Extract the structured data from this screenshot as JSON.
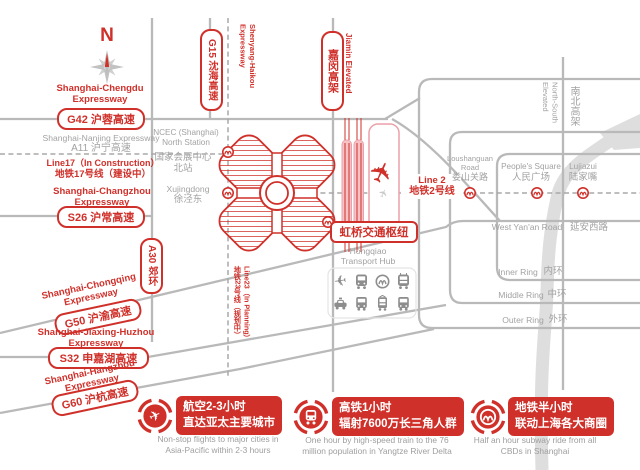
{
  "map": {
    "compass": {
      "n": "N"
    },
    "expressways": {
      "chengdu": {
        "l1": "Shanghai-Chengdu",
        "l2": "Expressway",
        "badge": "G42 沪蓉高速"
      },
      "nanjing": {
        "l1": "Shanghai-Nanjing Expressway",
        "l2": "A11 沪宁高速"
      },
      "line17": {
        "l1": "Line17（In Construction）",
        "l2": "地铁17号线（建设中）"
      },
      "changzhou": {
        "l1": "Shanghai-Changzhou",
        "l2": "Expressway",
        "badge": "S26 沪常高速"
      },
      "chongqing": {
        "l1": "Shanghai-Chongqing",
        "l2": "Expressway",
        "badge": "G50 沪渝高速"
      },
      "jiaxing": {
        "l1": "Shanghai-Jiaxing-Huzhou",
        "l2": "Expressway",
        "badge": "S32 申嘉湖高速"
      },
      "hangzhou": {
        "l1": "Shanghai-Hangzhou",
        "l2": "Expressway",
        "badge": "G60 沪杭高速"
      },
      "g15_badge": "G15 沈海高速",
      "shenyang": {
        "l1": "Shenyang-Haikou",
        "l2": "Expressway"
      },
      "a30_badge": "A30 郊环",
      "jiamin_badge": "嘉闵高架",
      "jiamin_en": "Jiamin Elevated"
    },
    "metro": {
      "line2_en": "Line 2",
      "line2_cn": "地铁2号线",
      "line23_en": "Line23（In Planning）",
      "line23_cn": "地铁23号线（规划中）"
    },
    "places": {
      "ncec_en1": "NCEC (Shanghai)",
      "ncec_en2": "North Station",
      "ncec_cn1": "国家会展中心",
      "ncec_cn2": "北站",
      "xujingdong_en": "Xujingdong",
      "xujingdong_cn": "徐泾东",
      "hub_box": "虹桥交通枢纽",
      "hub_en1": "Hongqiao",
      "hub_en2": "Transport Hub",
      "loushanguan_en1": "Loushanguan",
      "loushanguan_en2": "Road",
      "loushanguan_cn": "娄山关路",
      "peoples_en": "People's Square",
      "peoples_cn": "人民广场",
      "lujiazui_en": "Lujiazui",
      "lujiazui_cn": "陆家嘴",
      "ns_elevated_l1": "North-South",
      "ns_elevated_l2": "Elevated",
      "ns_elevated_cn": "南北高架",
      "yanan_en": "West Yan'an Road",
      "yanan_cn": "延安西路",
      "inner_en": "Inner Ring",
      "inner_cn": "内环",
      "middle_en": "Middle Ring",
      "middle_cn": "中环",
      "outer_en": "Outer Ring",
      "outer_cn": "外环"
    },
    "transport_icons": [
      "airplane",
      "train",
      "metro-logo",
      "hsr-train",
      "taxi",
      "bus",
      "tram",
      "bus"
    ]
  },
  "callouts": [
    {
      "icon": "airplane",
      "cn1": "航空2-3小时",
      "cn2": "直达亚太主要城市",
      "en1": "Non-stop flights to major cities in",
      "en2": "Asia-Pacific within 2-3 hours"
    },
    {
      "icon": "hsr-train",
      "cn1": "高铁1小时",
      "cn2": "辐射7600万长三角人群",
      "en1": "One hour by high-speed train to the 76",
      "en2": "million population in Yangtze River Delta"
    },
    {
      "icon": "metro-logo",
      "cn1": "地铁半小时",
      "cn2": "联动上海各大商圈",
      "en1": "Half an hour subway ride from all",
      "en2": "CBDs in Shanghai"
    }
  ],
  "colors": {
    "accent_red": "#d0302a",
    "road_gray": "#b9b9b9",
    "label_gray": "#a2a2a2",
    "river_gray": "#dedede"
  }
}
